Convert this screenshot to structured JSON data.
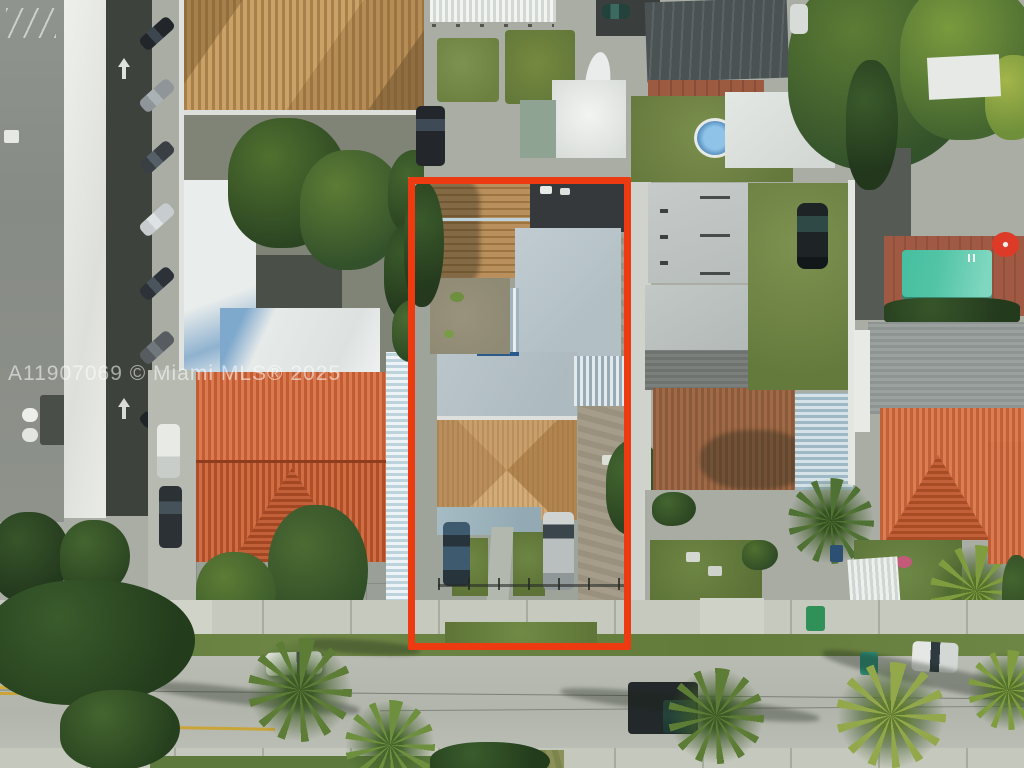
{
  "photo": {
    "type": "aerial drone photograph",
    "subject": "residential duplex property outlined in red, Miami neighborhood with tile and metal roofs, pool, palm-lined street"
  },
  "watermark": {
    "text": "A11907069 © Miami MLS® 2025"
  },
  "highlight": {
    "purpose": "subject property boundary",
    "color": "#ed3a10"
  },
  "palette": {
    "highlight_red": "#ed3a10",
    "pool_teal": "#4fc3a5",
    "umbrella_red": "#dd3b27",
    "orange_tile_roof": "#c35c33",
    "brown_tile_roof": "#8b5a3c",
    "tan_shingle_roof": "#c09a62",
    "subject_gray_roof": "#b8c4c9",
    "dark_metal_roof": "#4b5254",
    "white_roof": "#e9ebe7",
    "asphalt_road": "#b6b9b0",
    "sidewalk_concrete": "#c6c9be",
    "lawn_green": "#75893f",
    "tree_canopy_green": "#2d4a24",
    "palm_green": "#5d7c35",
    "trash_bin_green": "#2f9158",
    "truck_cab_teal": "#2d5148"
  }
}
